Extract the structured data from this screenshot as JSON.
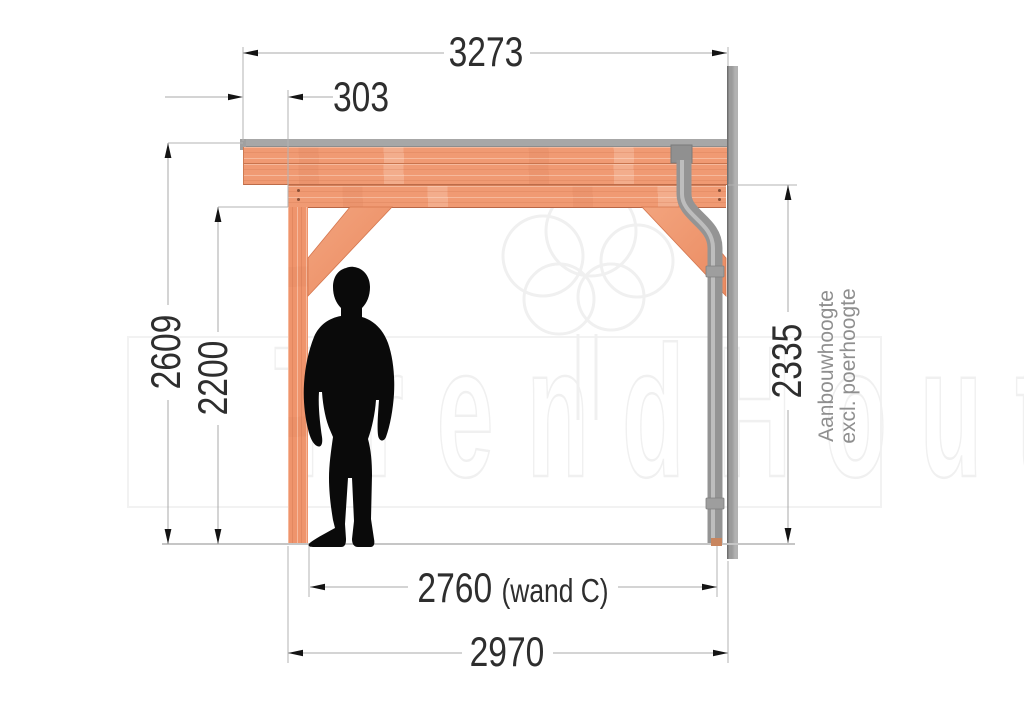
{
  "watermark": {
    "text": "TrendHout"
  },
  "dimensions": {
    "roof_width": "3273",
    "roof_overhang": "303",
    "total_height": "2609",
    "passage_height": "2200",
    "wall_attach_height": "2335",
    "inner_span_value": "2760",
    "inner_span_note": "(wand C)",
    "outer_span": "2970"
  },
  "labels": {
    "wall_note_line1": "Aanbouwhoogte",
    "wall_note_line2": "excl. poerhoogte"
  },
  "colors": {
    "wood": "#f09a73",
    "wood_shadow": "#bd6c49",
    "roof_cap": "#a7a7a7",
    "wall": "#9b9b9b",
    "downpipe": "#949494",
    "dimension_text": "#2e2e2e",
    "note_text": "#8f8f8f",
    "watermark_outline": "#f0f0f0"
  }
}
